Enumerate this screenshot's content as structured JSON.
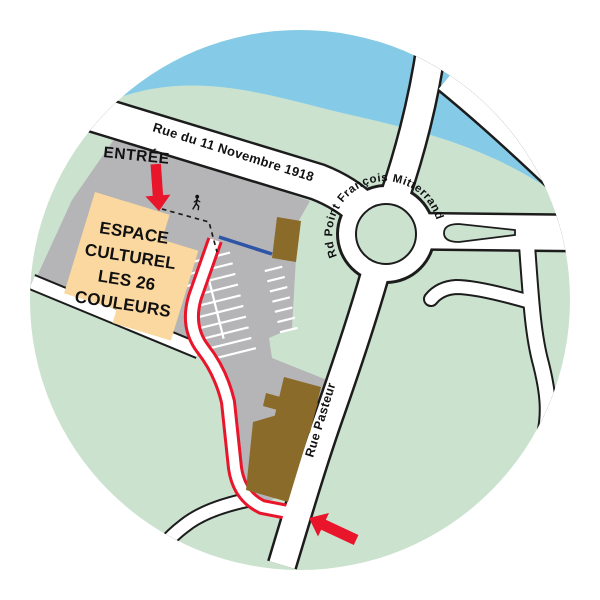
{
  "map": {
    "title": "Plan d'accès Espace Culturel Les 26 Couleurs",
    "venue": {
      "name_lines": [
        "ESPACE",
        "CULTUREL",
        "LES 26",
        "COULEURS"
      ],
      "entrance_label": "ENTRÉE"
    },
    "streets": {
      "north": "Rue du 11 Novembre 1918",
      "roundabout": "Rd Point François Mitterrand",
      "south": "Rue Pasteur"
    },
    "icons": {
      "entrance_arrow": "red arrow pointing down to venue entrance",
      "route_arrow": "red arrow pointing to junction on Rue Pasteur",
      "pedestrian": "walking person on dashed footpath"
    },
    "colors": {
      "background": "#ffffff",
      "land": "#cbe2cf",
      "water": "#85cbe7",
      "site_paving": "#b5b4b6",
      "venue_building": "#fbd89f",
      "other_buildings": "#8a6b29",
      "road_fill": "#ffffff",
      "road_casing": "#1c1c1c",
      "route_highlight": "#e9152b",
      "accessible_path": "#2d54a7",
      "parking_lines": "#ffffff",
      "text": "#111111"
    }
  }
}
